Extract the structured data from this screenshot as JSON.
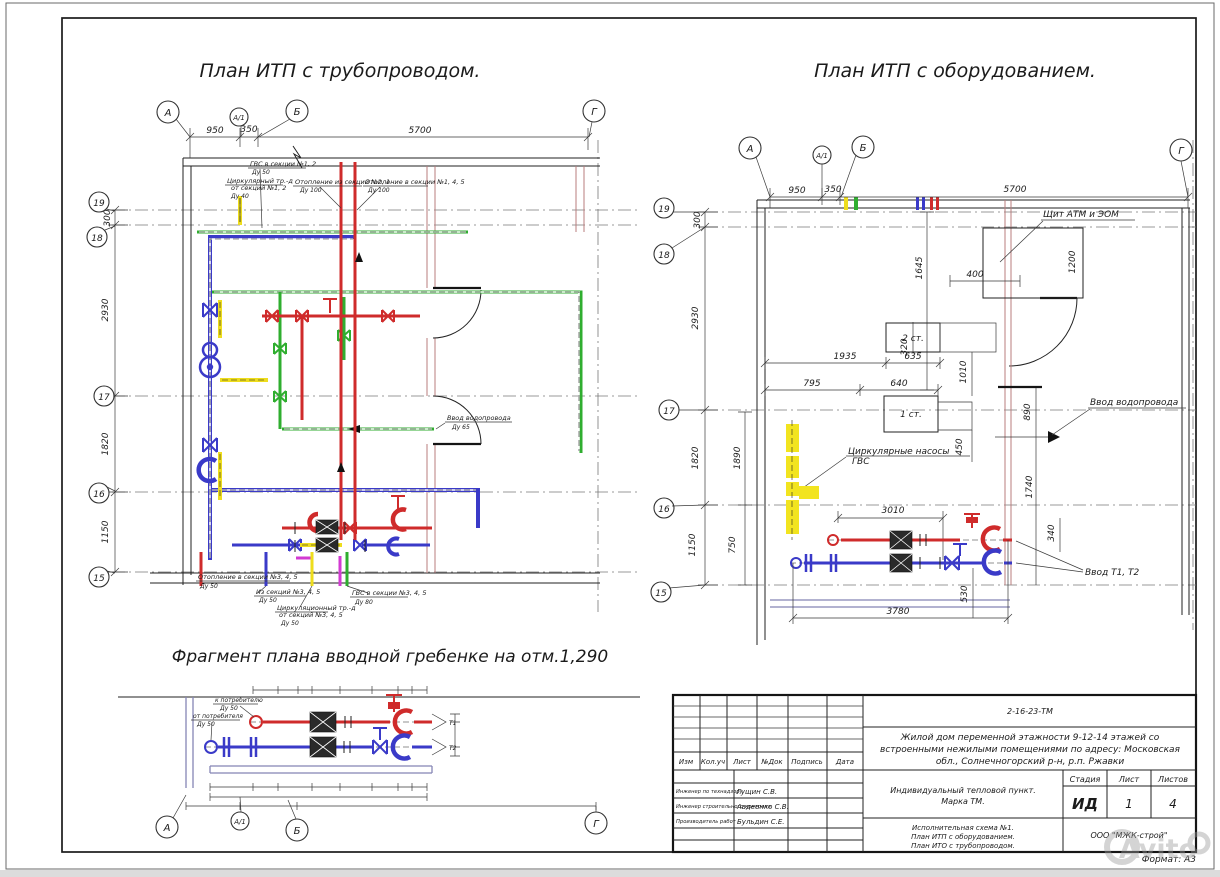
{
  "sheet": {
    "format_label": "Формат: А3",
    "watermark_text": "Avito"
  },
  "titles": {
    "left_plan": "План ИТП с трубопроводом.",
    "right_plan": "План ИТП с оборудованием.",
    "fragment": "Фрагмент плана вводной гребенке на отм.1,290"
  },
  "axes": {
    "a": "А",
    "a1": "А/1",
    "b": "Б",
    "g": "Г",
    "n19": "19",
    "n18": "18",
    "n17": "17",
    "n16": "16",
    "n15": "15"
  },
  "dims": {
    "d950": "950",
    "d350": "350",
    "d5700": "5700",
    "d300": "300",
    "d2930": "2930",
    "d1820": "1820",
    "d1150": "1150",
    "d1645": "1645",
    "d400": "400",
    "d1200": "1200",
    "d320": "320",
    "d1935": "1935",
    "d635": "635",
    "d795": "795",
    "d640": "640",
    "d1010": "1010",
    "d450": "450",
    "d890": "890",
    "d1740": "1740",
    "d1890": "1890",
    "d750": "750",
    "d3010": "3010",
    "d340": "340",
    "d530": "530",
    "d3780": "3780"
  },
  "left_plan": {
    "labels": {
      "gvs12": "ГВС в секции №1, 2",
      "gvs12_du": "Ду 50",
      "circ12_l1": "Циркулярный тр.-д",
      "circ12_l2": "от секций №1, 2",
      "circ12_du": "Ду 40",
      "heat_from": "Отопление из секций №2, 1",
      "heat_from_du": "Ду 100",
      "heat_to": "Отопление в секции №1, 4, 5",
      "heat_to_du": "Ду 100",
      "water": "Ввод водопровода",
      "water_du": "Ду 65",
      "heat345": "Отопление в секции №3, 4, 5",
      "heat345_du": "Ду 50",
      "from345": "Из секций №3, 4, 5",
      "from345_du": "Ду 50",
      "circ345_l1": "Циркуляционный тр.-д",
      "circ345_l2": "от секций №3, 4, 5",
      "circ345_du": "Ду 50",
      "gvs345": "ГВС в секции №3, 4, 5",
      "gvs345_du": "Ду 80"
    }
  },
  "right_plan": {
    "labels": {
      "panel": "Щит АТМ и ЭОМ",
      "water_inlet": "Ввод водопровода",
      "pumps_l1": "Циркулярные насосы",
      "pumps_l2": "ГВС",
      "inlet_t": "Ввод Т1, Т2",
      "stage2": "2 ст.",
      "stage1": "1 ст."
    }
  },
  "fragment": {
    "labels": {
      "to_consumer": "к потребителю",
      "to_consumer_du": "Ду 50",
      "from_consumer": "от потребителя",
      "from_consumer_du": "Ду 50",
      "t1": "Т1",
      "t2": "Т2"
    }
  },
  "titleblock": {
    "doc_number": "2-16-23-ТМ",
    "project_l1": "Жилой дом переменной этажности 9-12-14 этажей со",
    "project_l2": "встроенными нежилыми помещениями по адресу: Московская",
    "project_l3": "обл., Солнечногорский р-н, р.п. Ржавки",
    "object_l1": "Индивидуальный тепловой пункт.",
    "object_l2": "Марка ТМ.",
    "scheme_l1": "Исполнительная схема №1.",
    "scheme_l2": "План ИТП с оборудованием.",
    "scheme_l3": "План ИТО с трубопроводом.",
    "company": "ООО \"МЖК-строй\"",
    "stage_label": "Стадия",
    "sheet_label": "Лист",
    "sheets_label": "Листов",
    "stage": "ИД",
    "sheet": "1",
    "sheets": "4",
    "cols": {
      "izm": "Изм",
      "koluch": "Кол.уч",
      "list": "Лист",
      "ndok": "№Док",
      "podpis": "Подпись",
      "data": "Дата"
    },
    "signers": [
      {
        "role": "Инженер по технадзору",
        "name": "Гущин С.В."
      },
      {
        "role": "Инженер строительного контроля",
        "name": "Авдеенко С.В."
      },
      {
        "role": "Производитель работ",
        "name": "Бульдин С.Е."
      }
    ]
  }
}
